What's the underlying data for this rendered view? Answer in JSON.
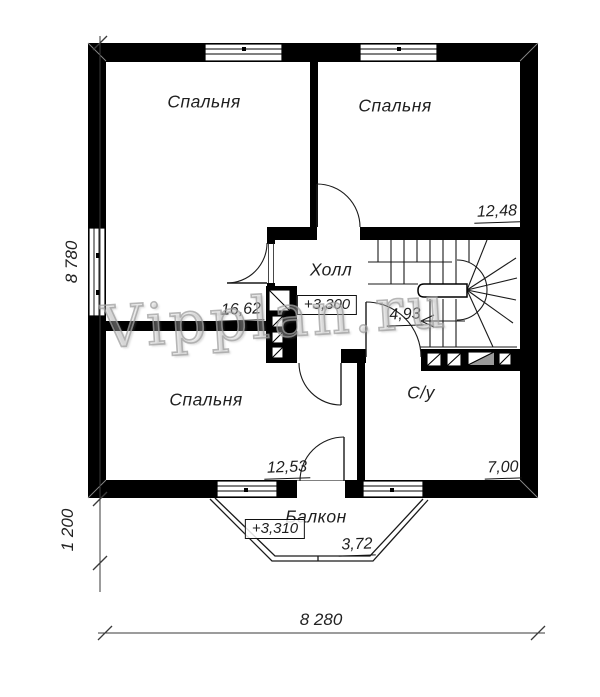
{
  "watermark": "Vipplan.ru",
  "rooms": [
    {
      "id": "bedroom-top-left",
      "name": "Спальня",
      "area": "16,62"
    },
    {
      "id": "bedroom-top-right",
      "name": "Спальня",
      "area": "12,48"
    },
    {
      "id": "hall",
      "name": "Холл",
      "area": "4,93",
      "elevation": "+3,300"
    },
    {
      "id": "bedroom-bottom",
      "name": "Спальня",
      "area": "12,53"
    },
    {
      "id": "bathroom",
      "name": "С/у",
      "area": "7,00"
    },
    {
      "id": "balcony",
      "name": "Балкон",
      "area": "3,72",
      "elevation": "+3,310"
    }
  ],
  "dimensions": {
    "height_total": "8 780",
    "balcony_depth": "1 200",
    "width_total": "8 280"
  },
  "colors": {
    "wall": "#000000",
    "background": "#ffffff",
    "line": "#1a1a1a",
    "dimension_line": "#3a3a3a",
    "watermark": "#bdbdbd"
  }
}
